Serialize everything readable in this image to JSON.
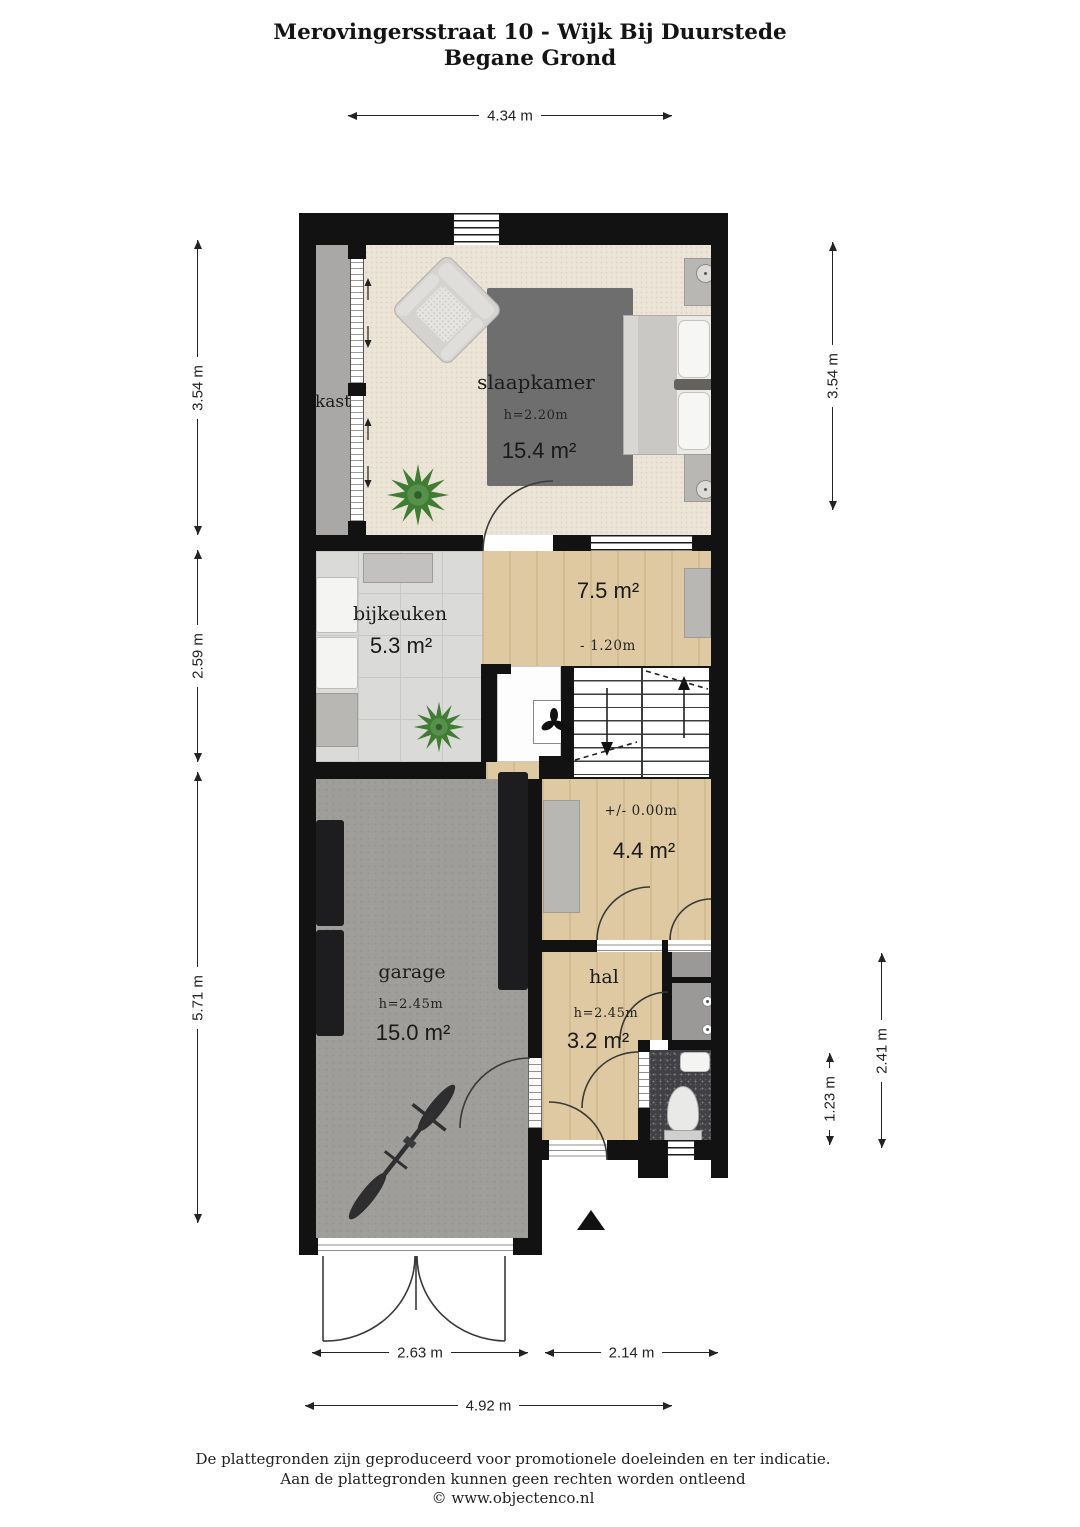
{
  "title": {
    "line1": "Merovingersstraat 10 - Wijk Bij Duurstede",
    "line2": "Begane Grond"
  },
  "rooms": {
    "slaapkamer": {
      "name": "slaapkamer",
      "ceiling_height": "h=2.20m",
      "area": "15.4 m²"
    },
    "kast": {
      "name": "kast"
    },
    "bijkeuken": {
      "name": "bijkeuken",
      "area": "5.3 m²"
    },
    "tussenniveau": {
      "area": "7.5 m²",
      "level": "- 1.20m"
    },
    "entreeniveau": {
      "area": "4.4 m²",
      "level": "+/- 0.00m"
    },
    "garage": {
      "name": "garage",
      "ceiling_height": "h=2.45m",
      "area": "15.0 m²"
    },
    "hal": {
      "name": "hal",
      "ceiling_height": "h=2.45m",
      "area": "3.2 m²"
    }
  },
  "dimensions": {
    "top_width": "4.34 m",
    "left_bedroom": "3.54 m",
    "left_middle": "2.59 m",
    "left_garage": "5.71 m",
    "right_bedroom": "3.54 m",
    "right_toilet": "1.23 m",
    "right_hall": "2.41 m",
    "bottom_garage": "2.63 m",
    "bottom_entrance": "2.14 m",
    "bottom_total": "4.92 m"
  },
  "footer": {
    "line1": "De plattegronden zijn geproduceerd voor promotionele doeleinden en ter indicatie.",
    "line2": "Aan de plattegronden kunnen geen rechten worden ontleend",
    "line3": "© www.objectenco.nl"
  },
  "colors": {
    "wall": "#121212",
    "carpet": "#ece5d7",
    "wood": "#dfc9a2",
    "tile": "#dadad8",
    "garage_floor": "#9f9e9a",
    "closet_gray": "#a9a8a6",
    "toilet_floor": "#404045",
    "rug": "#6e6e6f",
    "plant_green": "#47803a"
  }
}
